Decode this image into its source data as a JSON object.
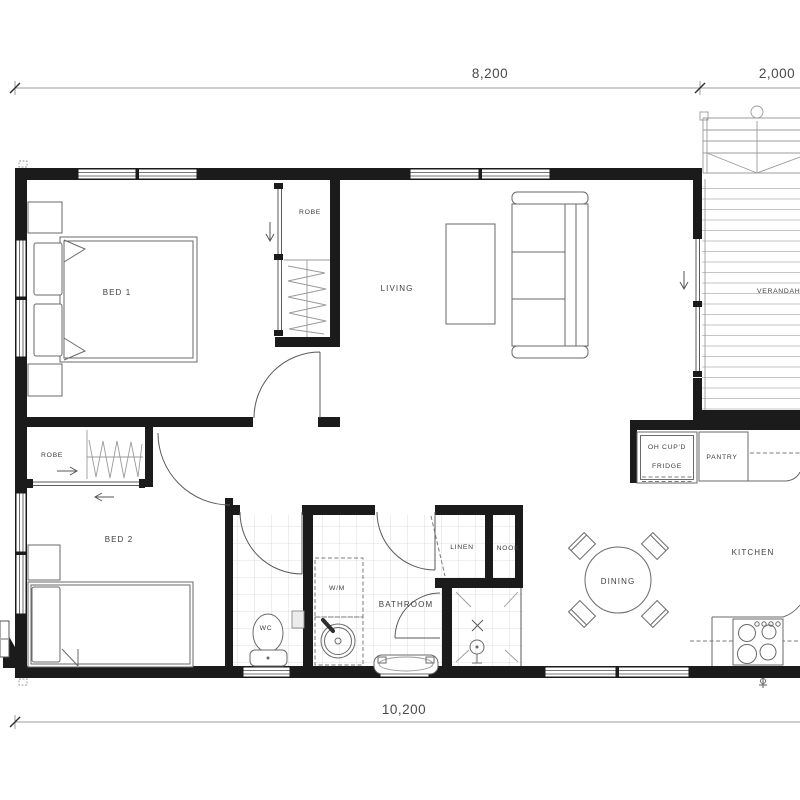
{
  "dimensions": {
    "top_main": "8,200",
    "top_verandah": "2,000",
    "bottom": "10,200"
  },
  "rooms": {
    "bed1": "BED 1",
    "bed1_robe": "ROBE",
    "living": "LIVING",
    "verandah": "VERANDAH",
    "bed2": "BED 2",
    "bed2_robe": "ROBE",
    "laundry_wm": "W/M",
    "wc": "WC",
    "bathroom": "BATHROOM",
    "linen": "LINEN",
    "nook": "NOOK",
    "dining": "DINING",
    "kitchen": "KITCHEN",
    "overhead_cupboard": "OH CUP'D",
    "fridge": "FRIDGE",
    "pantry": "PANTRY"
  },
  "colors": {
    "wall": "#1b1b1b",
    "furniture_line": "#6a6a6a",
    "fine_line": "#9b9b9b",
    "tile_line": "#d5d5d5",
    "deck_line": "#bdbdbd",
    "dashed_line": "#7a7a7a",
    "label_text": "#3e3e3e",
    "background": "#ffffff"
  }
}
